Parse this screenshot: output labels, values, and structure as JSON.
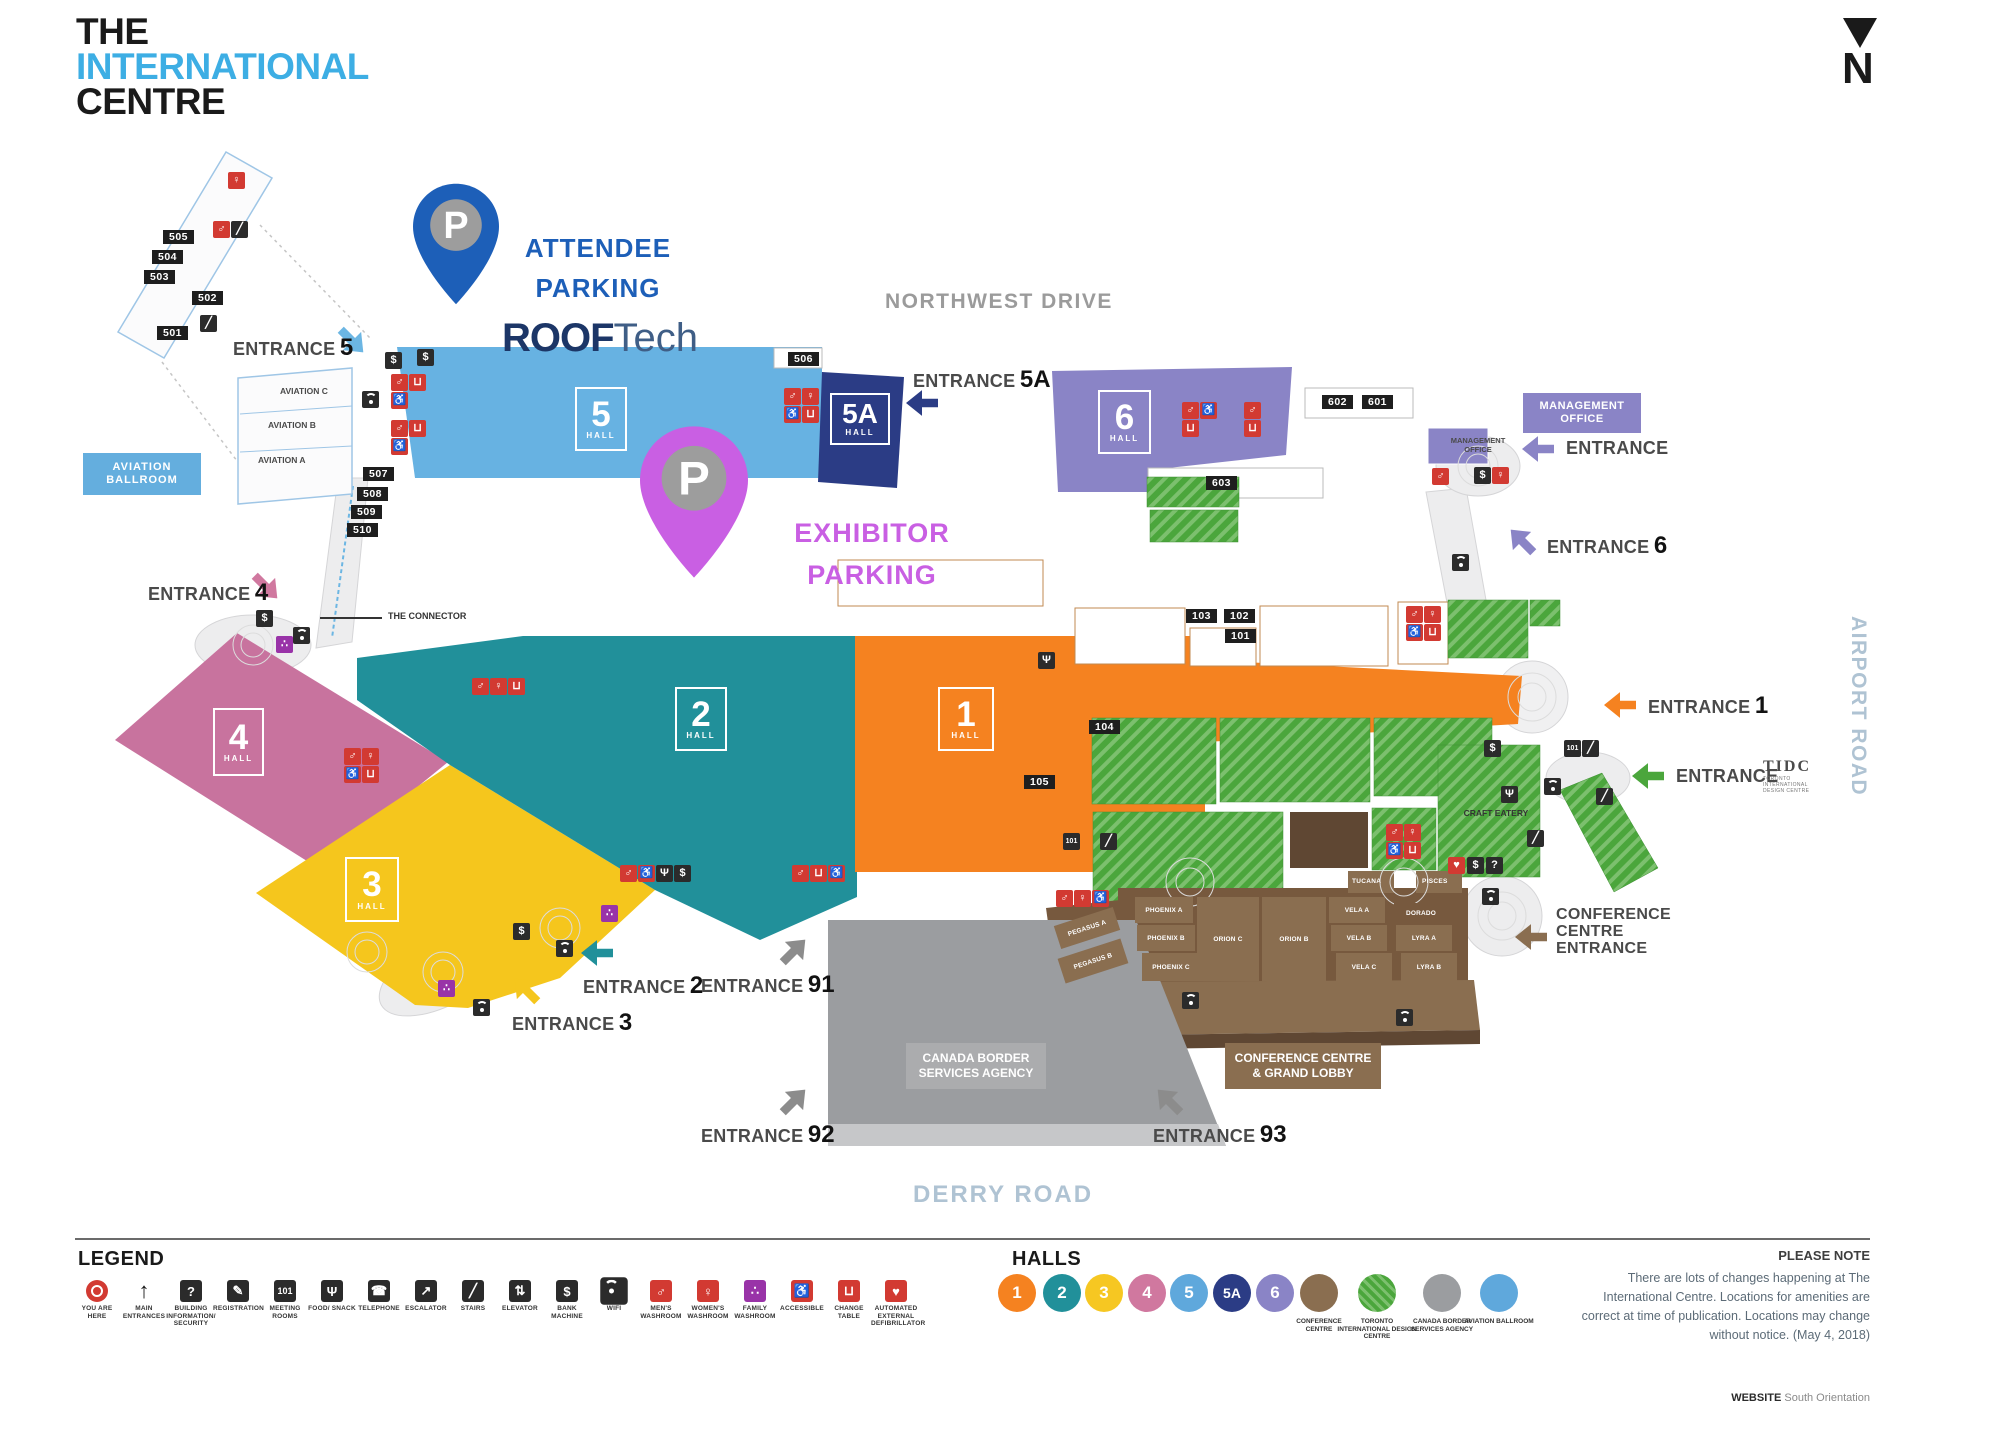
{
  "logo": {
    "l1": "THE",
    "l2": "INTERNATIONAL",
    "l3": "CENTRE"
  },
  "compass": {
    "n": "N"
  },
  "roads": {
    "nw": "NORTHWEST DRIVE",
    "derry": "DERRY ROAD",
    "airport": "AIRPORT ROAD"
  },
  "event": {
    "roof": "ROOF",
    "tech": "Tech"
  },
  "parking": {
    "p": "P",
    "attendee1": "ATTENDEE",
    "attendee2": "PARKING",
    "exhibitor1": "EXHIBITOR",
    "exhibitor2": "PARKING"
  },
  "halls": {
    "h1": {
      "num": "1",
      "word": "HALL"
    },
    "h2": {
      "num": "2",
      "word": "HALL"
    },
    "h3": {
      "num": "3",
      "word": "HALL"
    },
    "h4": {
      "num": "4",
      "word": "HALL"
    },
    "h5": {
      "num": "5",
      "word": "HALL"
    },
    "h5a": {
      "num": "5A",
      "word": "HALL"
    },
    "h6": {
      "num": "6",
      "word": "HALL"
    }
  },
  "entrances": {
    "e5": {
      "word": "ENTRANCE",
      "num": "5"
    },
    "e5a": {
      "word": "ENTRANCE",
      "num": "5A"
    },
    "e6": {
      "word": "ENTRANCE",
      "num": "6"
    },
    "e4": {
      "word": "ENTRANCE",
      "num": "4"
    },
    "e3": {
      "word": "ENTRANCE",
      "num": "3"
    },
    "e2": {
      "word": "ENTRANCE",
      "num": "2"
    },
    "e1": {
      "word": "ENTRANCE",
      "num": "1"
    },
    "e91": {
      "word": "ENTRANCE",
      "num": "91"
    },
    "e92": {
      "word": "ENTRANCE",
      "num": "92"
    },
    "e93": {
      "word": "ENTRANCE",
      "num": "93"
    },
    "mgmt": {
      "word": "ENTRANCE"
    },
    "tidc": {
      "word": "ENTRANCE"
    },
    "conf": {
      "l1": "CONFERENCE",
      "l2": "CENTRE",
      "l3": "ENTRANCE"
    }
  },
  "rooms": {
    "r501": "501",
    "r502": "502",
    "r503": "503",
    "r504": "504",
    "r505": "505",
    "r506": "506",
    "r507": "507",
    "r508": "508",
    "r509": "509",
    "r510": "510",
    "r601": "601",
    "r602": "602",
    "r603": "603",
    "r101": "101",
    "r102": "102",
    "r103": "103",
    "r104": "104",
    "r105": "105"
  },
  "aviation": {
    "ball1": "AVIATION",
    "ball2": "BALLROOM",
    "a": "AVIATION A",
    "b": "AVIATION B",
    "c": "AVIATION C"
  },
  "connector": "THE CONNECTOR",
  "mgmt": {
    "box1": "MANAGEMENT",
    "box2": "OFFICE",
    "map1": "MANAGEMENT",
    "map2": "OFFICE"
  },
  "conference": {
    "label1": "CONFERENCE CENTRE",
    "label2": "& GRAND LOBBY",
    "rooms": {
      "pegasus_a": "PEGASUS A",
      "pegasus_b": "PEGASUS B",
      "phoenix_a": "PHOENIX A",
      "phoenix_b": "PHOENIX B",
      "phoenix_c": "PHOENIX C",
      "orion_c": "ORION C",
      "orion_b": "ORION B",
      "vela_a": "VELA A",
      "vela_b": "VELA B",
      "vela_c": "VELA C",
      "dorado": "DORADO",
      "lyra_a": "LYRA A",
      "lyra_b": "LYRA B",
      "tucana": "TUCANA",
      "pisces": "PISCES"
    }
  },
  "cbsa": {
    "l1": "CANADA BORDER",
    "l2": "SERVICES AGENCY"
  },
  "craft": "CRAFT EATERY",
  "tidc": {
    "abbr": "TIDC",
    "sub1": "TORONTO",
    "sub2": "INTERNATIONAL",
    "sub3": "DESIGN CENTRE"
  },
  "legend": {
    "title": "LEGEND",
    "items": [
      {
        "label": "YOU ARE HERE"
      },
      {
        "label": "MAIN ENTRANCES"
      },
      {
        "label": "BUILDING INFORMATION/ SECURITY"
      },
      {
        "label": "REGISTRATION"
      },
      {
        "label": "MEETING ROOMS"
      },
      {
        "label": "FOOD/ SNACK"
      },
      {
        "label": "TELEPHONE"
      },
      {
        "label": "ESCALATOR"
      },
      {
        "label": "STAIRS"
      },
      {
        "label": "ELEVATOR"
      },
      {
        "label": "BANK MACHINE"
      },
      {
        "label": "WIFI"
      },
      {
        "label": "MEN'S WASHROOM"
      },
      {
        "label": "WOMEN'S WASHROOM"
      },
      {
        "label": "FAMILY WASHROOM"
      },
      {
        "label": "ACCESSIBLE"
      },
      {
        "label": "CHANGE TABLE"
      },
      {
        "label": "AUTOMATED EXTERNAL DEFIBRILLATOR"
      }
    ]
  },
  "halls_legend": {
    "title": "HALLS",
    "areas": [
      {
        "label": "CONFERENCE CENTRE"
      },
      {
        "label": "TORONTO INTERNATIONAL DESIGN CENTRE"
      },
      {
        "label": "CANADA BORDER SERVICES AGENCY"
      },
      {
        "label": "AVIATION BALLROOM"
      }
    ]
  },
  "note": {
    "title": "PLEASE NOTE",
    "body": "There are lots of changes happening at The International Centre. Locations for amenities are correct at time of publication. Locations may change without notice. (May 4, 2018)"
  },
  "website": {
    "label": "WEBSITE",
    "value": "South Orientation"
  },
  "icons": {
    "dollar": "$",
    "mens": "♂",
    "womens": "♀",
    "family": "∴",
    "accessible": "♿",
    "changetable": "⊔",
    "food": "Ψ",
    "telephone": "☎",
    "stairs": "╱",
    "escalator": "↗",
    "elevator": "⇅",
    "meeting": "101",
    "registration": "✎",
    "info": "?",
    "aed": "♥",
    "mainentrance": "↑"
  }
}
